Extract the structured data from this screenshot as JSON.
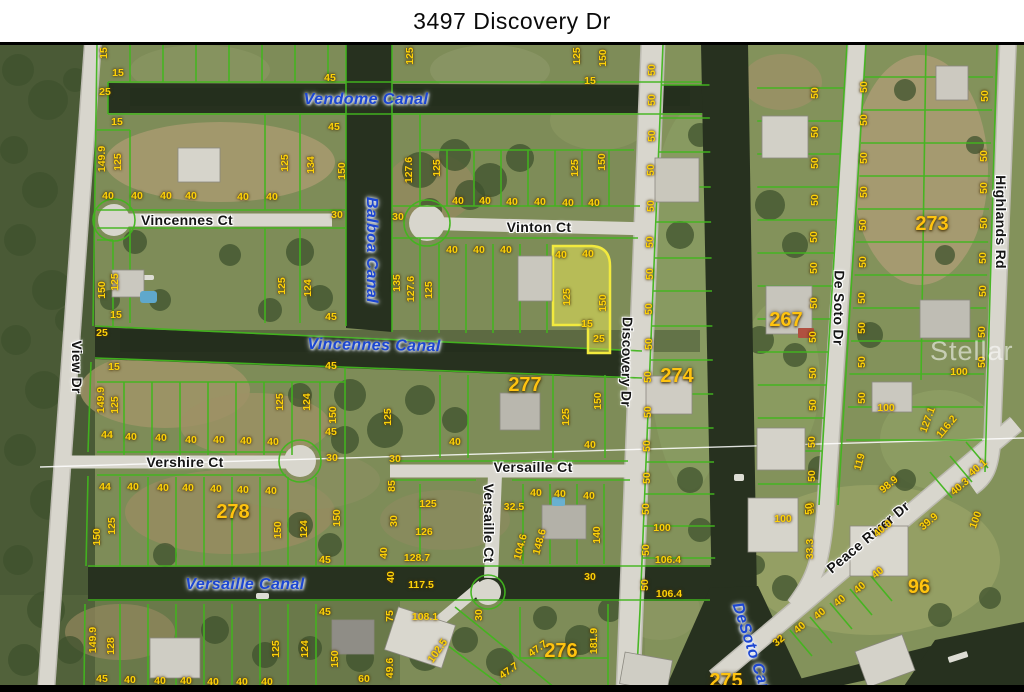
{
  "title": "3497 Discovery Dr",
  "watermark": "Stellar MLS",
  "colors": {
    "parcel_line": "#42b61e",
    "highlight_fill": "#f0ec55",
    "highlight_border": "#f2ea3e",
    "canal_label": "#1c46d2",
    "dim_label": "#fdd108",
    "block_label": "#ffc30f",
    "road": "#d8d6cd",
    "water": "#27311f"
  },
  "map": {
    "label_format": "[text, x, y, rotation_deg]",
    "street_labels": [
      [
        "Vincennes Ct",
        187,
        220,
        0
      ],
      [
        "Vinton Ct",
        539,
        227,
        0
      ],
      [
        "Vershire Ct",
        185,
        462,
        0
      ],
      [
        "Versaille Ct",
        533,
        467,
        0
      ],
      [
        "Versaille Ct",
        489,
        523,
        90
      ],
      [
        "View Dr",
        77,
        367,
        90
      ],
      [
        "Discovery Dr",
        627,
        362,
        91
      ],
      [
        "De Soto Dr",
        839,
        308,
        91
      ],
      [
        "Highlands Rd",
        1001,
        222,
        90
      ],
      [
        "Peace River Dr",
        868,
        537,
        -40
      ]
    ],
    "canal_labels": [
      [
        "Vendome Canal",
        366,
        100,
        0
      ],
      [
        "Balboa Canal",
        371,
        250,
        90
      ],
      [
        "Vincennes Canal",
        374,
        346,
        1
      ],
      [
        "Versaille Canal",
        245,
        585,
        0
      ],
      [
        "DeSoto Canal",
        753,
        655,
        72
      ]
    ],
    "block_numbers": [
      [
        "273",
        932,
        224
      ],
      [
        "267",
        786,
        320
      ],
      [
        "274",
        677,
        376
      ],
      [
        "277",
        525,
        385
      ],
      [
        "278",
        233,
        512
      ],
      [
        "276",
        561,
        651
      ],
      [
        "275",
        726,
        681
      ],
      [
        "96",
        919,
        587
      ]
    ],
    "highlighted_parcel_dims": [
      "40",
      "40",
      "125",
      "150",
      "15",
      "25"
    ],
    "dimension_labels": [
      [
        "15",
        104,
        53,
        -90
      ],
      [
        "15",
        118,
        73,
        0
      ],
      [
        "25",
        105,
        92,
        0
      ],
      [
        "15",
        117,
        122,
        0
      ],
      [
        "149.9",
        102,
        159,
        -90
      ],
      [
        "125",
        118,
        162,
        -90
      ],
      [
        "40",
        108,
        196,
        0
      ],
      [
        "40",
        137,
        196,
        0
      ],
      [
        "40",
        166,
        196,
        0
      ],
      [
        "40",
        191,
        196,
        0
      ],
      [
        "40",
        243,
        197,
        0
      ],
      [
        "40",
        272,
        197,
        0
      ],
      [
        "45",
        330,
        78,
        0
      ],
      [
        "45",
        334,
        127,
        0
      ],
      [
        "125",
        285,
        163,
        -90
      ],
      [
        "134",
        311,
        165,
        -90
      ],
      [
        "150",
        342,
        171,
        -90
      ],
      [
        "30",
        337,
        215,
        0
      ],
      [
        "125",
        410,
        56,
        -90
      ],
      [
        "125",
        577,
        56,
        -90
      ],
      [
        "150",
        603,
        58,
        -90
      ],
      [
        "15",
        590,
        81,
        0
      ],
      [
        "127.6",
        409,
        170,
        -90
      ],
      [
        "125",
        437,
        168,
        -90
      ],
      [
        "125",
        575,
        168,
        -90
      ],
      [
        "150",
        602,
        162,
        -90
      ],
      [
        "40",
        458,
        201,
        0
      ],
      [
        "40",
        485,
        201,
        0
      ],
      [
        "40",
        512,
        202,
        0
      ],
      [
        "40",
        540,
        202,
        0
      ],
      [
        "40",
        568,
        203,
        0
      ],
      [
        "40",
        594,
        203,
        0
      ],
      [
        "30",
        398,
        217,
        0
      ],
      [
        "40",
        452,
        250,
        0
      ],
      [
        "40",
        479,
        250,
        0
      ],
      [
        "40",
        506,
        250,
        0
      ],
      [
        "135",
        397,
        283,
        -90
      ],
      [
        "127.6",
        411,
        289,
        -90
      ],
      [
        "125",
        429,
        290,
        -90
      ],
      [
        "40",
        561,
        255,
        0
      ],
      [
        "40",
        588,
        254,
        0
      ],
      [
        "125",
        567,
        297,
        -90
      ],
      [
        "150",
        603,
        303,
        -90
      ],
      [
        "15",
        587,
        324,
        0
      ],
      [
        "25",
        599,
        339,
        0
      ],
      [
        "50",
        652,
        70,
        -90
      ],
      [
        "50",
        652,
        100,
        -90
      ],
      [
        "50",
        652,
        136,
        -90
      ],
      [
        "50",
        651,
        170,
        -90
      ],
      [
        "50",
        651,
        206,
        -90
      ],
      [
        "50",
        650,
        242,
        -90
      ],
      [
        "50",
        650,
        274,
        -90
      ],
      [
        "50",
        649,
        309,
        -90
      ],
      [
        "50",
        649,
        344,
        -90
      ],
      [
        "50",
        648,
        377,
        -90
      ],
      [
        "50",
        648,
        412,
        -90
      ],
      [
        "50",
        647,
        446,
        -90
      ],
      [
        "50",
        647,
        478,
        -90
      ],
      [
        "50",
        646,
        509,
        -90
      ],
      [
        "50",
        646,
        550,
        -90
      ],
      [
        "50",
        645,
        585,
        -90
      ],
      [
        "50",
        815,
        93,
        -90
      ],
      [
        "50",
        815,
        132,
        -90
      ],
      [
        "50",
        815,
        163,
        -90
      ],
      [
        "50",
        815,
        200,
        -90
      ],
      [
        "50",
        814,
        237,
        -90
      ],
      [
        "50",
        814,
        268,
        -90
      ],
      [
        "50",
        814,
        303,
        -90
      ],
      [
        "50",
        813,
        337,
        -90
      ],
      [
        "50",
        813,
        373,
        -90
      ],
      [
        "50",
        813,
        405,
        -90
      ],
      [
        "50",
        812,
        442,
        -90
      ],
      [
        "50",
        812,
        476,
        -90
      ],
      [
        "50",
        811,
        508,
        -90
      ],
      [
        "50",
        864,
        87,
        -90
      ],
      [
        "50",
        864,
        120,
        -90
      ],
      [
        "50",
        864,
        158,
        -90
      ],
      [
        "50",
        864,
        192,
        -90
      ],
      [
        "50",
        863,
        225,
        -90
      ],
      [
        "50",
        863,
        262,
        -90
      ],
      [
        "50",
        862,
        298,
        -90
      ],
      [
        "50",
        862,
        328,
        -90
      ],
      [
        "50",
        862,
        362,
        -90
      ],
      [
        "50",
        862,
        398,
        -90
      ],
      [
        "50",
        985,
        96,
        -90
      ],
      [
        "50",
        984,
        156,
        -90
      ],
      [
        "50",
        984,
        188,
        -90
      ],
      [
        "50",
        984,
        223,
        -90
      ],
      [
        "50",
        983,
        258,
        -90
      ],
      [
        "50",
        983,
        291,
        -90
      ],
      [
        "50",
        982,
        332,
        -90
      ],
      [
        "50",
        982,
        362,
        -90
      ],
      [
        "100",
        959,
        372,
        0
      ],
      [
        "100",
        886,
        408,
        0
      ],
      [
        "127.1",
        928,
        420,
        -70
      ],
      [
        "116.2",
        947,
        427,
        -50
      ],
      [
        "15",
        114,
        367,
        0
      ],
      [
        "45",
        331,
        317,
        0
      ],
      [
        "45",
        331,
        366,
        0
      ],
      [
        "150",
        102,
        290,
        -90
      ],
      [
        "125",
        115,
        282,
        -90
      ],
      [
        "15",
        116,
        315,
        0
      ],
      [
        "25",
        102,
        333,
        0
      ],
      [
        "125",
        282,
        286,
        -90
      ],
      [
        "124",
        308,
        288,
        -90
      ],
      [
        "149.9",
        101,
        400,
        -90
      ],
      [
        "125",
        115,
        405,
        -90
      ],
      [
        "44",
        107,
        435,
        0
      ],
      [
        "40",
        131,
        437,
        0
      ],
      [
        "40",
        161,
        438,
        0
      ],
      [
        "40",
        191,
        440,
        0
      ],
      [
        "40",
        219,
        440,
        0
      ],
      [
        "40",
        246,
        441,
        0
      ],
      [
        "40",
        273,
        442,
        0
      ],
      [
        "45",
        331,
        432,
        0
      ],
      [
        "124",
        307,
        402,
        -90
      ],
      [
        "125",
        280,
        402,
        -90
      ],
      [
        "150",
        333,
        415,
        -90
      ],
      [
        "40",
        455,
        442,
        0
      ],
      [
        "40",
        590,
        445,
        0
      ],
      [
        "125",
        566,
        417,
        -90
      ],
      [
        "150",
        598,
        401,
        -90
      ],
      [
        "125",
        388,
        417,
        -90
      ],
      [
        "44",
        105,
        487,
        0
      ],
      [
        "40",
        133,
        487,
        0
      ],
      [
        "40",
        163,
        488,
        0
      ],
      [
        "40",
        188,
        488,
        0
      ],
      [
        "40",
        216,
        489,
        0
      ],
      [
        "40",
        243,
        490,
        0
      ],
      [
        "40",
        271,
        491,
        0
      ],
      [
        "30",
        332,
        458,
        0
      ],
      [
        "150",
        97,
        537,
        -90
      ],
      [
        "125",
        112,
        526,
        -90
      ],
      [
        "150",
        278,
        530,
        -90
      ],
      [
        "124",
        304,
        529,
        -90
      ],
      [
        "150",
        337,
        518,
        -90
      ],
      [
        "45",
        325,
        560,
        0
      ],
      [
        "149.9",
        93,
        640,
        -90
      ],
      [
        "128",
        111,
        646,
        -90
      ],
      [
        "45",
        102,
        679,
        0
      ],
      [
        "40",
        130,
        680,
        0
      ],
      [
        "40",
        160,
        681,
        0
      ],
      [
        "40",
        186,
        681,
        0
      ],
      [
        "40",
        213,
        682,
        0
      ],
      [
        "40",
        242,
        682,
        0
      ],
      [
        "40",
        267,
        682,
        0
      ],
      [
        "125",
        276,
        649,
        -90
      ],
      [
        "124",
        305,
        649,
        -90
      ],
      [
        "150",
        335,
        659,
        -90
      ],
      [
        "45",
        325,
        612,
        0
      ],
      [
        "60",
        364,
        679,
        0
      ],
      [
        "75",
        390,
        616,
        -90
      ],
      [
        "40",
        391,
        577,
        -90
      ],
      [
        "49.6",
        390,
        668,
        -90
      ],
      [
        "30",
        395,
        459,
        0
      ],
      [
        "85",
        392,
        486,
        -90
      ],
      [
        "125",
        428,
        504,
        0
      ],
      [
        "126",
        424,
        532,
        0
      ],
      [
        "30",
        394,
        521,
        -90
      ],
      [
        "40",
        384,
        553,
        -90
      ],
      [
        "128.7",
        417,
        558,
        0
      ],
      [
        "117.5",
        421,
        585,
        0
      ],
      [
        "108.1",
        425,
        617,
        0
      ],
      [
        "102.5",
        438,
        651,
        -55
      ],
      [
        "30",
        479,
        615,
        -90
      ],
      [
        "32.5",
        514,
        507,
        0
      ],
      [
        "104.6",
        521,
        547,
        -75
      ],
      [
        "148.6",
        540,
        542,
        -75
      ],
      [
        "140",
        597,
        535,
        -90
      ],
      [
        "40",
        536,
        493,
        0
      ],
      [
        "40",
        560,
        494,
        0
      ],
      [
        "40",
        589,
        496,
        0
      ],
      [
        "30",
        590,
        577,
        0
      ],
      [
        "181.9",
        594,
        641,
        -90
      ],
      [
        "47.7",
        538,
        649,
        -35
      ],
      [
        "47.7",
        509,
        671,
        -35
      ],
      [
        "100",
        662,
        528,
        0
      ],
      [
        "106.4",
        668,
        560,
        0
      ],
      [
        "106.4",
        669,
        594,
        0
      ],
      [
        "33.3",
        810,
        549,
        -90
      ],
      [
        "50",
        809,
        509,
        -90
      ],
      [
        "100",
        783,
        519,
        0
      ],
      [
        "119",
        860,
        462,
        -75
      ],
      [
        "98.9",
        889,
        485,
        -40
      ],
      [
        "40.1",
        978,
        468,
        -40
      ],
      [
        "40.3",
        960,
        487,
        -40
      ],
      [
        "39.9",
        929,
        522,
        -40
      ],
      [
        "40.0",
        883,
        529,
        -40
      ],
      [
        "40",
        878,
        573,
        -40
      ],
      [
        "40",
        860,
        588,
        -40
      ],
      [
        "40",
        840,
        601,
        -40
      ],
      [
        "40",
        820,
        614,
        -40
      ],
      [
        "40",
        800,
        628,
        -40
      ],
      [
        "32",
        779,
        641,
        -40
      ],
      [
        "100",
        976,
        520,
        -70
      ]
    ]
  }
}
